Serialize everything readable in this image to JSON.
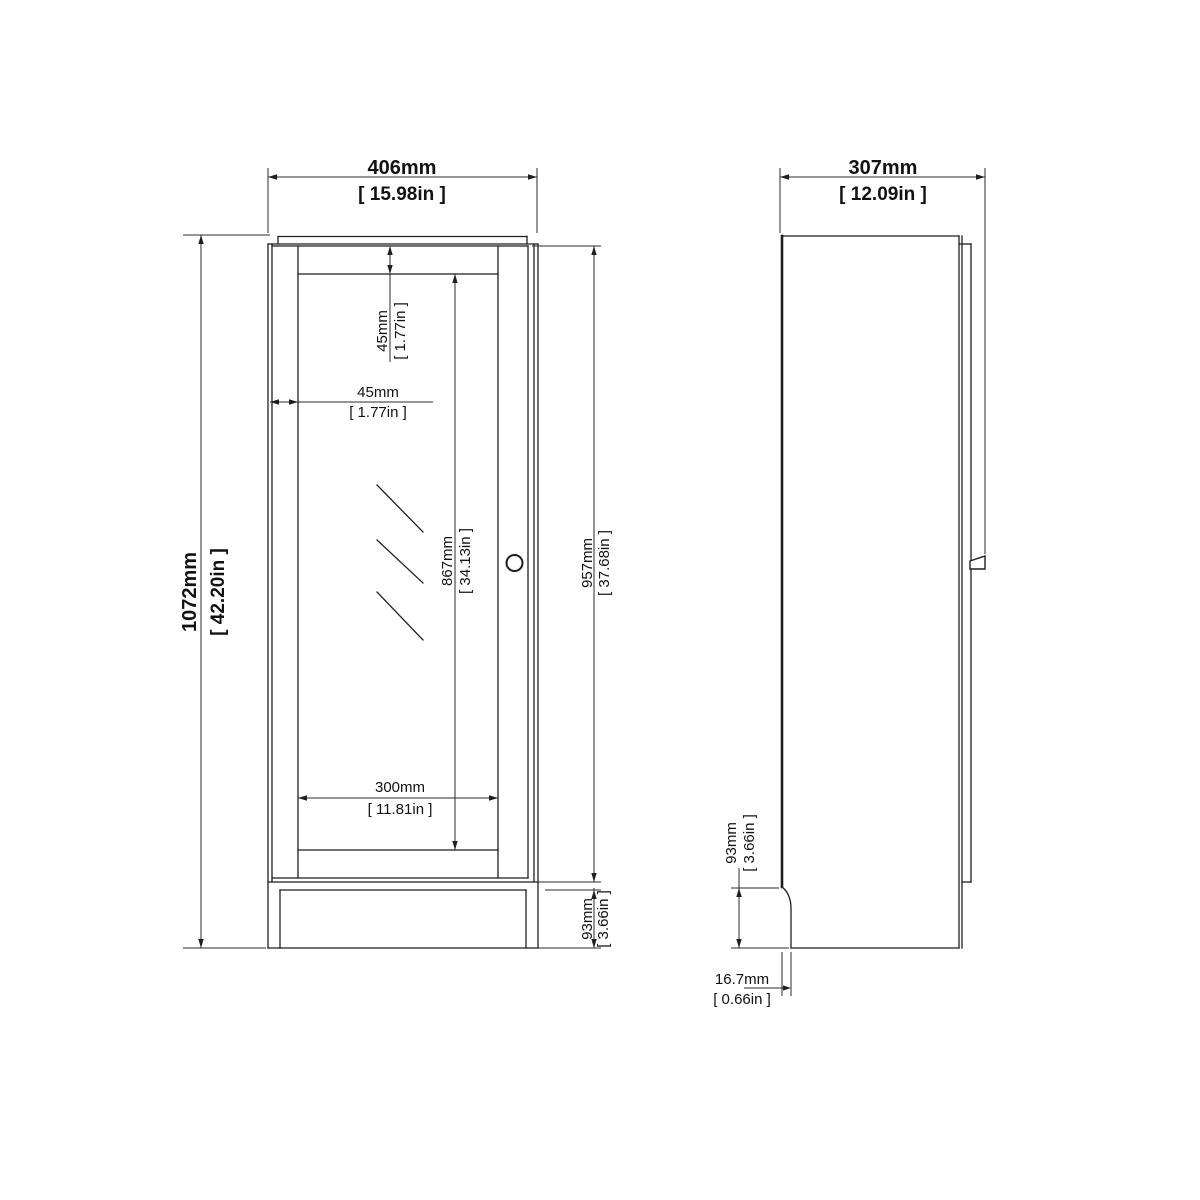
{
  "colors": {
    "background": "#ffffff",
    "line": "#1f1f1f",
    "text": "#121212"
  },
  "front_view": {
    "width_mm": "406mm",
    "width_in": "[ 15.98in ]",
    "height_mm": "1072mm",
    "height_in": "[ 42.20in ]",
    "door_height_mm": "957mm",
    "door_height_in": "[ 37.68in ]",
    "glass_height_mm": "867mm",
    "glass_height_in": "[ 34.13in ]",
    "glass_width_mm": "300mm",
    "glass_width_in": "[ 11.81in ]",
    "top_rail_mm": "45mm",
    "top_rail_in": "[ 1.77in ]",
    "side_stile_mm": "45mm",
    "side_stile_in": "[ 1.77in ]",
    "plinth_height_mm": "93mm",
    "plinth_height_in": "[ 3.66in ]"
  },
  "side_view": {
    "depth_mm": "307mm",
    "depth_in": "[ 12.09in ]",
    "plinth_height_mm": "93mm",
    "plinth_height_in": "[ 3.66in ]",
    "base_inset_mm": "16.7mm",
    "base_inset_in": "[ 0.66in ]"
  }
}
